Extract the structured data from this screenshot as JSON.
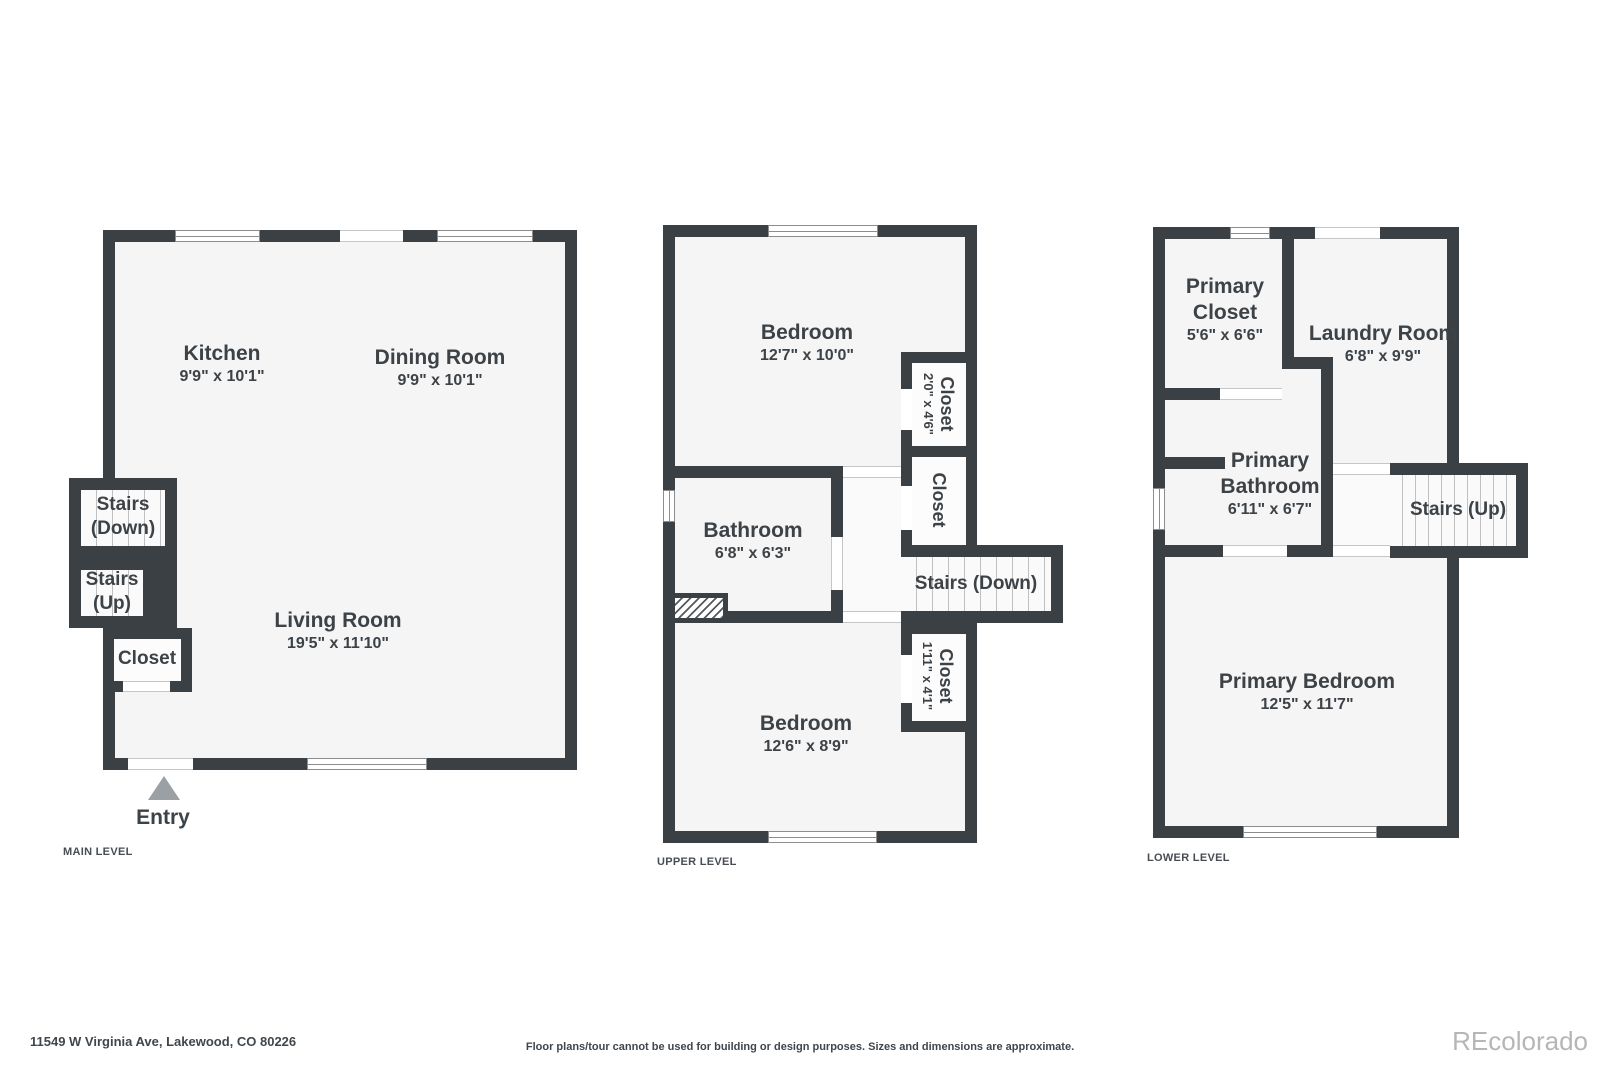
{
  "main_level": {
    "label": "MAIN LEVEL",
    "kitchen": {
      "name": "Kitchen",
      "dims": "9'9\" x 10'1\""
    },
    "dining_room": {
      "name": "Dining Room",
      "dims": "9'9\" x 10'1\""
    },
    "living_room": {
      "name": "Living Room",
      "dims": "19'5\" x 11'10\""
    },
    "stairs_down": {
      "line1": "Stairs",
      "line2": "(Down)"
    },
    "stairs_up": {
      "line1": "Stairs",
      "line2": "(Up)"
    },
    "closet": {
      "name": "Closet"
    },
    "entry": {
      "label": "Entry"
    }
  },
  "upper_level": {
    "label": "UPPER LEVEL",
    "bedroom_top": {
      "name": "Bedroom",
      "dims": "12'7\" x 10'0\""
    },
    "bathroom": {
      "name": "Bathroom",
      "dims": "6'8\" x 6'3\""
    },
    "closet_top": {
      "name": "Closet",
      "dims": "2'0\" x 4'6\""
    },
    "closet_middle": {
      "name": "Closet"
    },
    "closet_bottom": {
      "name": "Closet",
      "dims": "1'11\" x 4'1\""
    },
    "stairs": {
      "label": "Stairs (Down)"
    },
    "bedroom_bottom": {
      "name": "Bedroom",
      "dims": "12'6\" x 8'9\""
    }
  },
  "lower_level": {
    "label": "LOWER LEVEL",
    "primary_closet": {
      "line1": "Primary",
      "line2": "Closet",
      "dims": "5'6\" x 6'6\""
    },
    "laundry_room": {
      "name": "Laundry Room",
      "dims": "6'8\" x 9'9\""
    },
    "primary_bathroom": {
      "line1": "Primary",
      "line2": "Bathroom",
      "dims": "6'11\" x 6'7\""
    },
    "stairs": {
      "label": "Stairs (Up)"
    },
    "primary_bedroom": {
      "name": "Primary Bedroom",
      "dims": "12'5\" x 11'7\""
    }
  },
  "footer": {
    "address": "11549 W Virginia Ave, Lakewood, CO 80226",
    "disclaimer": "Floor plans/tour cannot be used for building or design purposes. Sizes and dimensions are approximate.",
    "logo": "REcolorado"
  },
  "colors": {
    "wall": "#3b4044",
    "room_fill": "#f5f5f5",
    "stairs_fill": "#fafafa",
    "label_text": "#3d4247",
    "entry_arrow": "#9ba0a4",
    "logo_text": "#b6b6b6"
  }
}
